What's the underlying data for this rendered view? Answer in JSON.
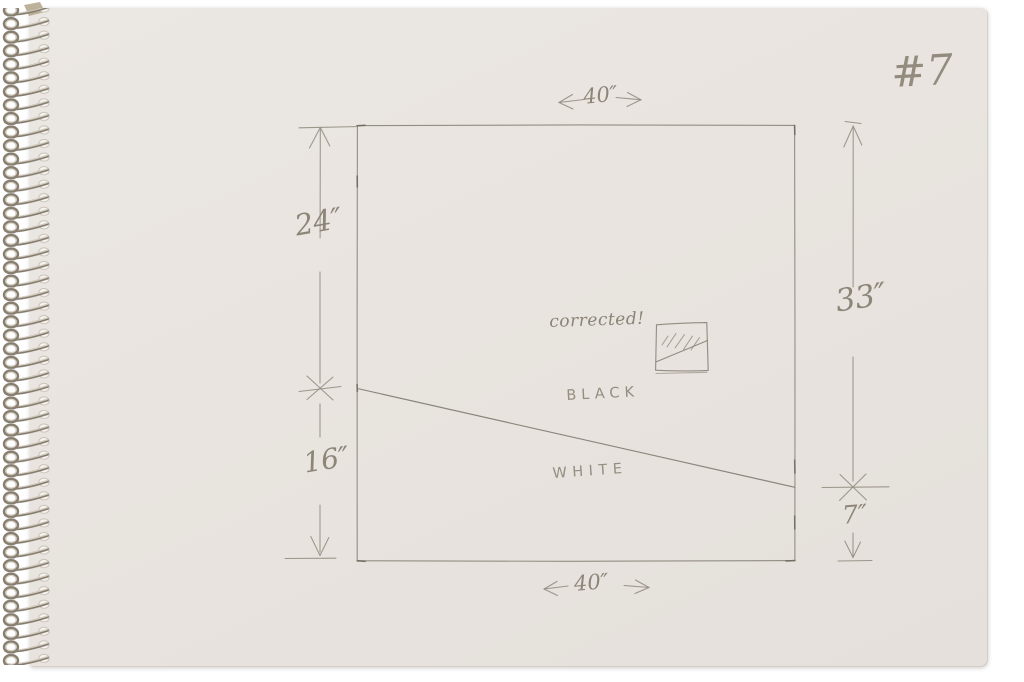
{
  "page": {
    "number": "#7"
  },
  "labels": {
    "note": "corrected!",
    "upper_region": "BLACK",
    "lower_region": "WHITE"
  },
  "dimensions": {
    "top_width": "40″",
    "bottom_width": "40″",
    "left_upper_height": "24″",
    "left_lower_height": "16″",
    "right_upper_height": "33″",
    "right_lower_height": "7″"
  },
  "colors": {
    "background": "#ffffff",
    "paper": "#e9e4df",
    "pencil": "#8b8479",
    "binding_wire": "#82796b"
  }
}
